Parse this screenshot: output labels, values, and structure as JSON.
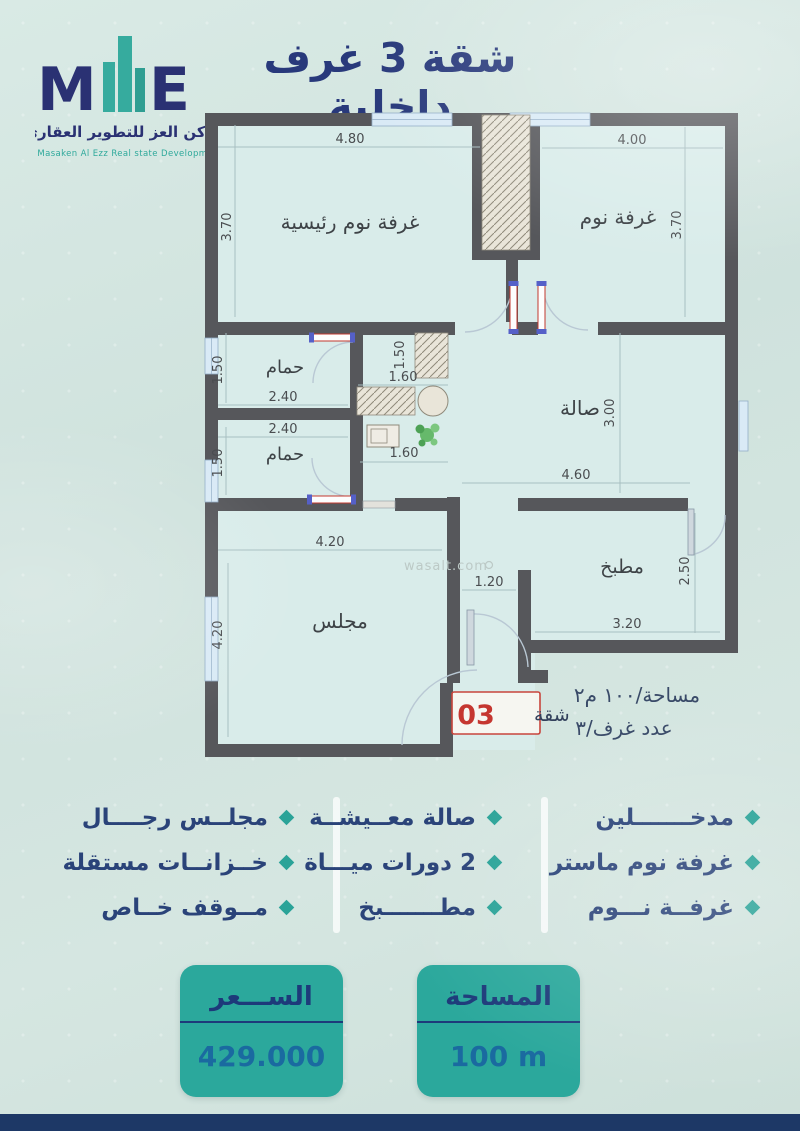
{
  "header": {
    "title": "شقة 3 غرف داخلية",
    "logo": {
      "monogram_left": "M",
      "monogram_right": "E",
      "brand_ar": "مساكن العز للتطوير العقاري",
      "brand_en": "Masaken Al Ezz Real state Development"
    }
  },
  "plan": {
    "rooms": {
      "master": "غرفة نوم رئيسية",
      "bedroom": "غرفة نوم",
      "bath1": "حمام",
      "bath2": "حمام",
      "hall": "صالة",
      "majlis": "مجلس",
      "kitchen": "مطبخ"
    },
    "dims": {
      "master_w": "4.80",
      "master_h": "3.70",
      "bedroom_w": "4.00",
      "bedroom_h": "3.70",
      "bath1_w": "2.40",
      "bath1_h": "1.50",
      "bath2_w": "2.40",
      "bath2_h": "1.50",
      "utility_top": "1.60",
      "utility_closet": "1.50",
      "utility_bottom": "1.60",
      "hall_w": "4.60",
      "hall_h": "3.00",
      "majlis_w": "4.20",
      "majlis_h": "4.20",
      "entry_w": "1.20",
      "kitchen_w": "3.20",
      "kitchen_h": "2.50"
    },
    "watermark": "wasalt.com",
    "unit_badge": {
      "label": "شقة",
      "number": "03"
    },
    "meta": {
      "area_line": "مساحة/١٠٠ م٢",
      "rooms_line": "عدد غرف/٣"
    }
  },
  "features": {
    "col1": [
      "مدخـــــــلين",
      "غرفة نوم ماستر",
      "غرفــة نـــوم"
    ],
    "col2": [
      "صالة معــيشــة",
      "2 دورات ميـــاة",
      "مطـــــــبخ"
    ],
    "col3": [
      "مجلــس رجــــال",
      "خــزانــات مستقلة",
      "مــوقف خــاص"
    ]
  },
  "cards": {
    "price": {
      "title": "الســـعر",
      "value": "429.000"
    },
    "area": {
      "title": "المساحة",
      "value": "100 m"
    }
  },
  "colors": {
    "teal": "#2ba89c",
    "navy": "#28397b",
    "wall_gray": "#56575b",
    "window_blue": "#d9eaf6",
    "accent_red": "#c53630",
    "background": "#d3e4df"
  }
}
